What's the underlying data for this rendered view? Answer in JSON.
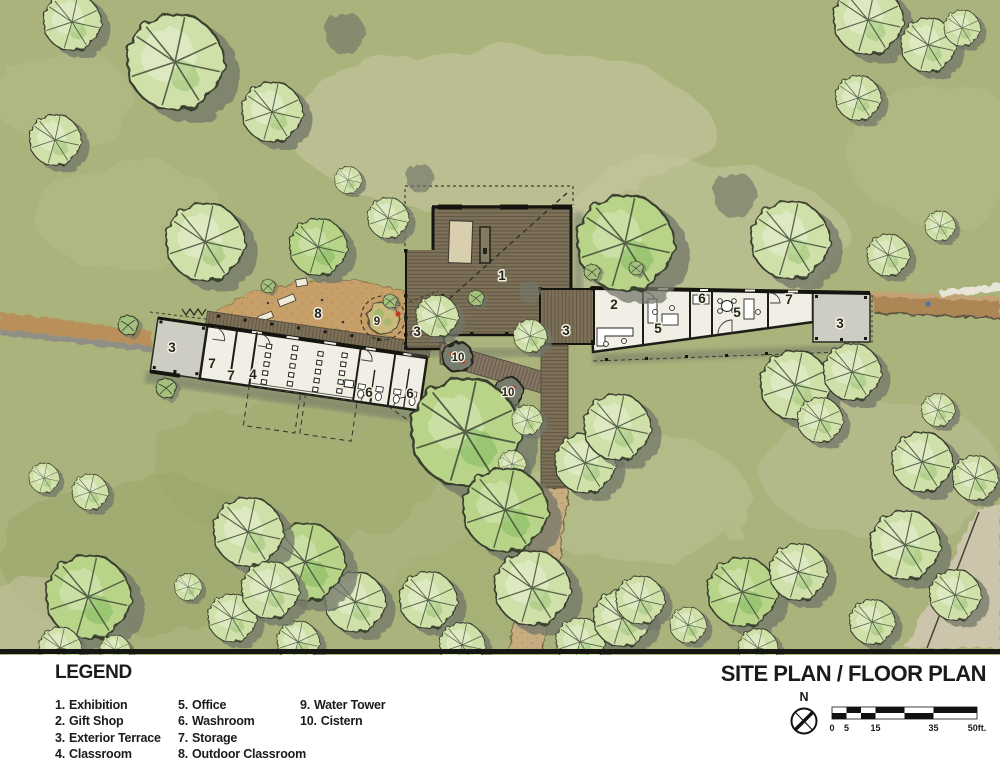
{
  "title": "SITE PLAN / FLOOR PLAN",
  "legend": {
    "title": "LEGEND",
    "items": [
      {
        "num": "1.",
        "label": "Exhibition"
      },
      {
        "num": "2.",
        "label": "Gift Shop"
      },
      {
        "num": "3.",
        "label": "Exterior Terrace"
      },
      {
        "num": "4.",
        "label": "Classroom"
      },
      {
        "num": "5.",
        "label": "Office"
      },
      {
        "num": "6.",
        "label": "Washroom"
      },
      {
        "num": "7.",
        "label": "Storage"
      },
      {
        "num": "8.",
        "label": "Outdoor Classroom"
      },
      {
        "num": "9.",
        "label": "Water Tower"
      },
      {
        "num": "10.",
        "label": "Cistern"
      }
    ]
  },
  "compass": {
    "label": "N"
  },
  "scale_bar": {
    "ticks": [
      "0",
      "5",
      "15",
      "35",
      "50ft."
    ]
  },
  "rooms": {
    "exhibition": "1",
    "gift_shop": "2",
    "exterior_terrace": "3",
    "classroom": "4",
    "office": "5",
    "washroom": "6",
    "storage": "7",
    "outdoor_classroom": "8",
    "water_tower": "9",
    "cistern": "10"
  },
  "colors": {
    "grass": "#a9b37b",
    "wood_deck": "#7c7058",
    "dirt": "#c79f69",
    "building_interior": "#f1efe5",
    "terrace_gray": "#cdcdc4",
    "cistern_accent": "#c23b22"
  }
}
